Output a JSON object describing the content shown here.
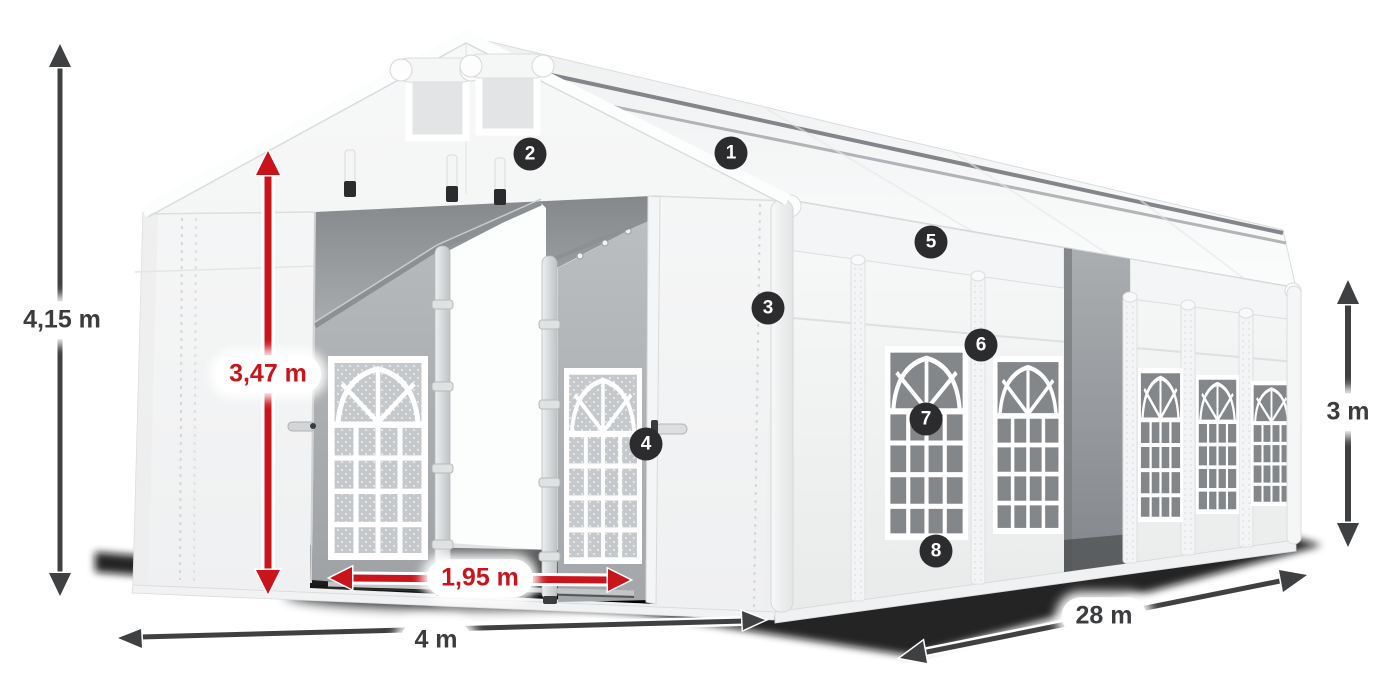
{
  "diagram": {
    "title": "Tent dimensions illustration",
    "dimensions": {
      "total_height": {
        "label": "4,15 m",
        "color": "#3b3c3e",
        "axis": "vertical"
      },
      "entrance_height": {
        "label": "3,47 m",
        "color": "#c9141c",
        "axis": "vertical"
      },
      "entrance_width": {
        "label": "1,95 m",
        "color": "#c9141c",
        "axis": "horizontal"
      },
      "front_width": {
        "label": "4 m",
        "color": "#3b3c3e",
        "axis": "horizontal"
      },
      "length": {
        "label": "28 m",
        "color": "#3b3c3e",
        "axis": "diagonal"
      },
      "side_height": {
        "label": "3 m",
        "color": "#3b3c3e",
        "axis": "vertical"
      }
    },
    "callouts": [
      {
        "number": "1"
      },
      {
        "number": "2"
      },
      {
        "number": "3"
      },
      {
        "number": "4"
      },
      {
        "number": "5"
      },
      {
        "number": "6"
      },
      {
        "number": "7"
      },
      {
        "number": "8"
      }
    ],
    "colors": {
      "dark_arrow": "#3f4042",
      "red_arrow": "#c9141c",
      "badge_background": "#2c2c2e",
      "badge_text": "#ffffff",
      "tent_white": "#f6f7f7",
      "interior_gray": "#a8abae",
      "shadow": "#0b0c0c"
    }
  }
}
